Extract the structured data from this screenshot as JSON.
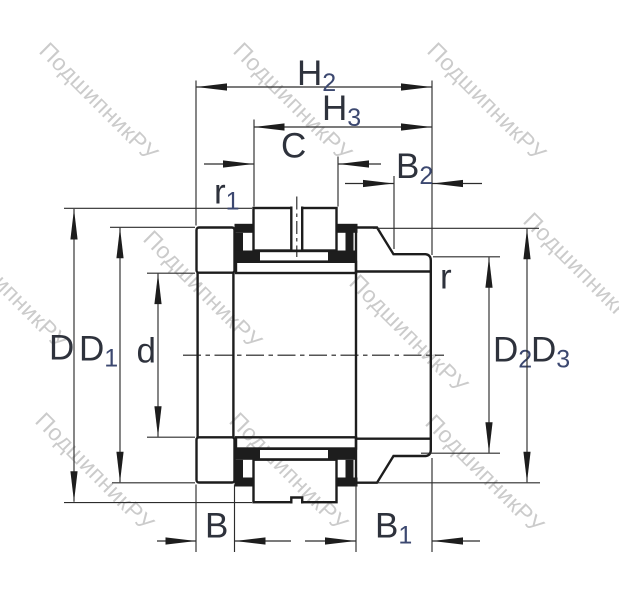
{
  "watermark": {
    "text": "ПодшипникРУ"
  },
  "labels": {
    "h2": {
      "base": "H",
      "sub": "2"
    },
    "h3": {
      "base": "H",
      "sub": "3"
    },
    "c": {
      "base": "C",
      "sub": ""
    },
    "b2": {
      "base": "B",
      "sub": "2"
    },
    "r1": {
      "base": "r",
      "sub": "1"
    },
    "r": {
      "base": "r",
      "sub": ""
    },
    "d_outer": {
      "base": "D",
      "sub": ""
    },
    "d1": {
      "base": "D",
      "sub": "1"
    },
    "d_bore": {
      "base": "d",
      "sub": ""
    },
    "d2": {
      "base": "D",
      "sub": "2"
    },
    "d3": {
      "base": "D",
      "sub": "3"
    },
    "b": {
      "base": "B",
      "sub": ""
    },
    "b1": {
      "base": "B",
      "sub": "1"
    }
  },
  "colors": {
    "line": "#1d1d1d",
    "dimension_line": "#2c2c2c",
    "label": "#2e323c",
    "label_subscript": "#3c4870",
    "watermark": "#cbcbcb",
    "background": "#ffffff"
  }
}
